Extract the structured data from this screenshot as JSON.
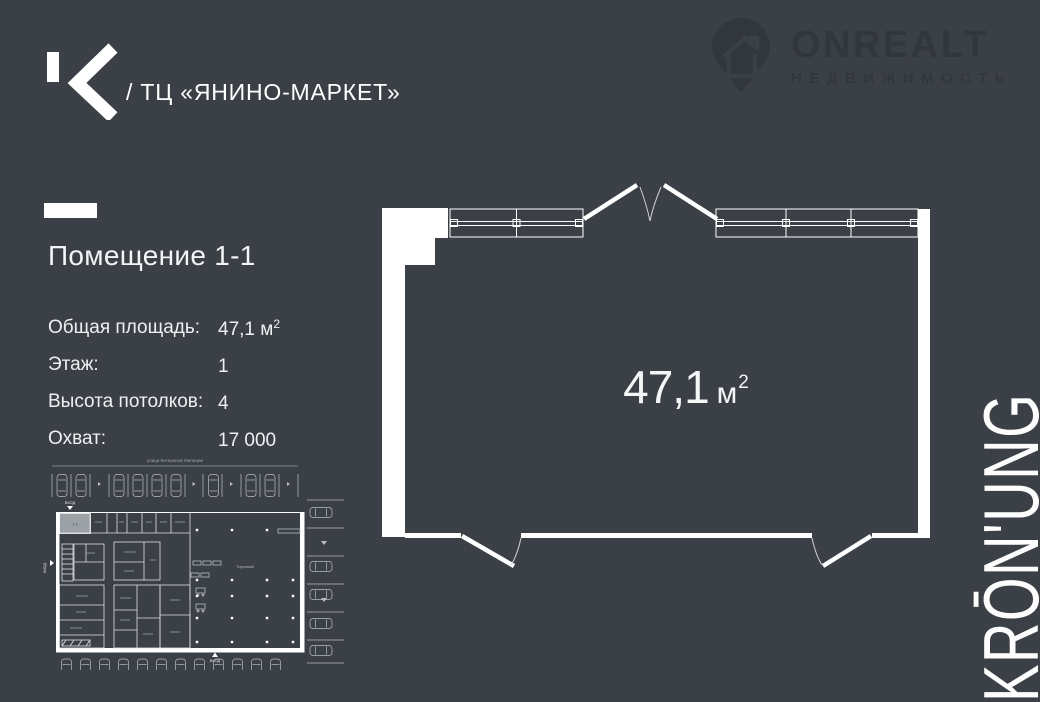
{
  "colors": {
    "background": "#3b4046",
    "watermark": "#32373e",
    "line_white": "#ffffff",
    "text": "#eef0f2",
    "highlight_room": "#9ca1a6"
  },
  "header": {
    "building_title": "/ ТЦ «ЯНИНО-МАРКЕТ»",
    "watermark_brand": "ONREALT",
    "watermark_subtitle": "НЕДВИЖИМОСТЬ"
  },
  "listing": {
    "title": "Помещение 1-1",
    "details": [
      {
        "label": "Общая площадь:",
        "value": "47,1 м",
        "sup": "2"
      },
      {
        "label": "Этаж:",
        "value": "1",
        "sup": ""
      },
      {
        "label": "Высота потолков:",
        "value": "4",
        "sup": ""
      },
      {
        "label": "Охват:",
        "value": "17 000",
        "sup": ""
      }
    ]
  },
  "floor_plan": {
    "area_number": "47,1",
    "area_unit": "м",
    "area_sup": "2"
  },
  "site_plan": {
    "street_label": "улица Ветеранов Милиции",
    "entrance_label": "ВХОД",
    "hall_label": "Торговый",
    "room_label": "1-1"
  },
  "brand_vertical": "KRŌN'UNG"
}
